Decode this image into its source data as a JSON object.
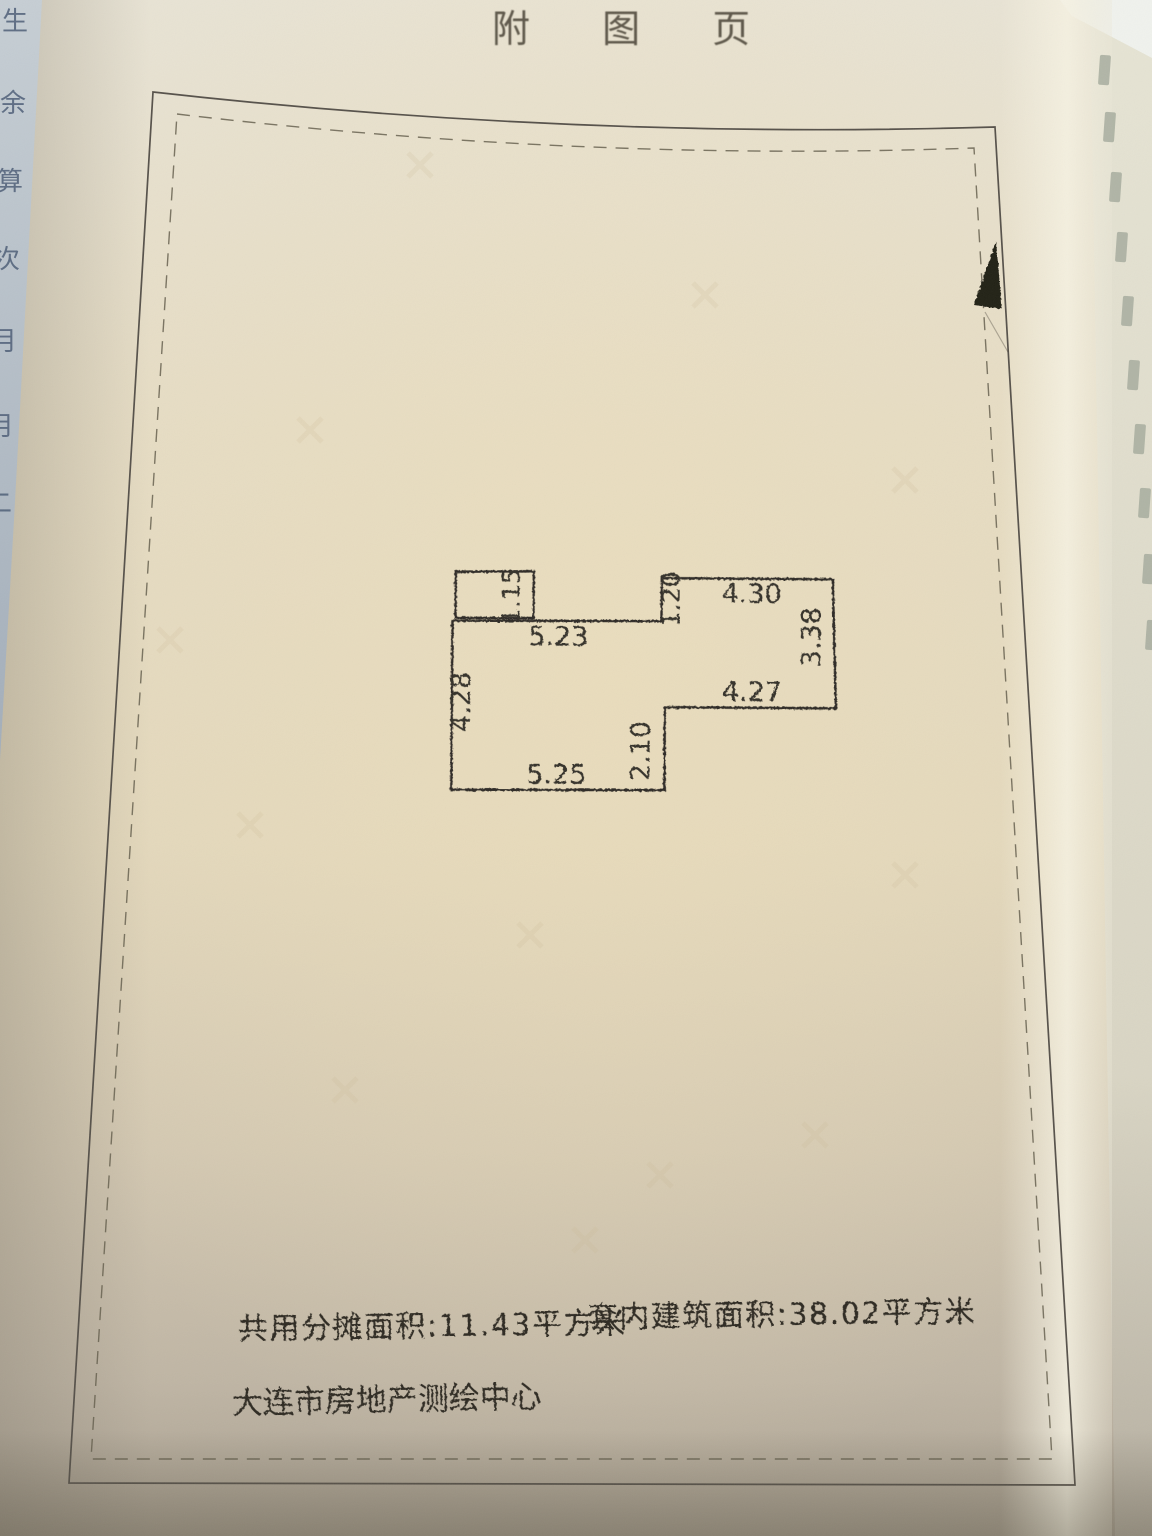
{
  "title": "附 图 页",
  "floor_plan": {
    "dimension_labels": {
      "balcony_depth": "1.15",
      "upper_width": "5.23",
      "left_height": "4.28",
      "lower_width": "5.25",
      "step_height": "2.10",
      "right_room_left_height": "1.20",
      "right_room_top_width": "4.30",
      "right_room_right_height": "3.38",
      "right_room_bottom_width": "4.27"
    }
  },
  "areas": {
    "shared_allocation": "共用分摊面积:11.43平方米",
    "interior_floor_area": "套内建筑面积:38.02平方米"
  },
  "agency": "大连市房地产测绘中心",
  "left_page_edge_characters": {
    "c0": "生",
    "c1": "余",
    "c2": "算",
    "c3": "次",
    "c4": "月",
    "c5": "月",
    "c6": "二"
  },
  "colors": {
    "paper": "#e3d9c2",
    "paper_shadow": "#a89f90",
    "ink": "#2e2b26",
    "frame_line": "#56514a",
    "under_page_blue": "#b9c3cb",
    "north_arrow": "#242119"
  }
}
